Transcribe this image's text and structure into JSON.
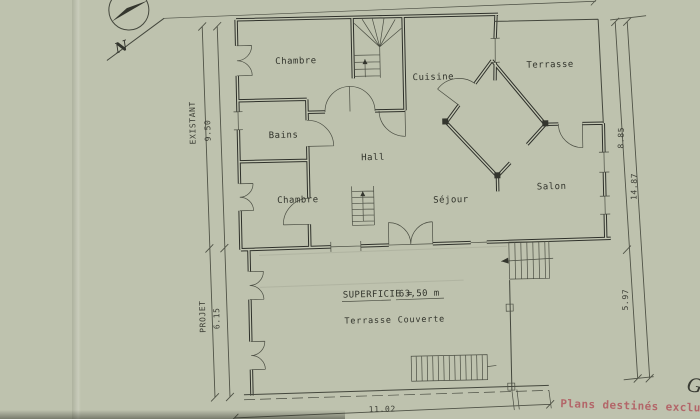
{
  "compass": {
    "north_label": "N"
  },
  "sections": {
    "existing_label": "EXISTANT",
    "existing_height": "9.50",
    "project_label": "PROJET",
    "project_height": "6.15"
  },
  "rooms": {
    "bedroom_top": "Chambre",
    "kitchen": "Cuisine",
    "terrace": "Terrasse",
    "bathroom": "Bains",
    "hall": "Hall",
    "bedroom_bottom": "Chambre",
    "living_room": "Séjour",
    "salon": "Salon",
    "covered_terrace": "Terrasse Couverte"
  },
  "area": {
    "label": "SUPERFICIE =",
    "value": "63,50 m"
  },
  "dims": {
    "right_upper": "8.85",
    "right_total": "14.87",
    "right_lower": "5.97",
    "bottom_width": "11.02"
  },
  "notes": {
    "stamp": "Plans destinés exclusivement",
    "mark": "G"
  }
}
